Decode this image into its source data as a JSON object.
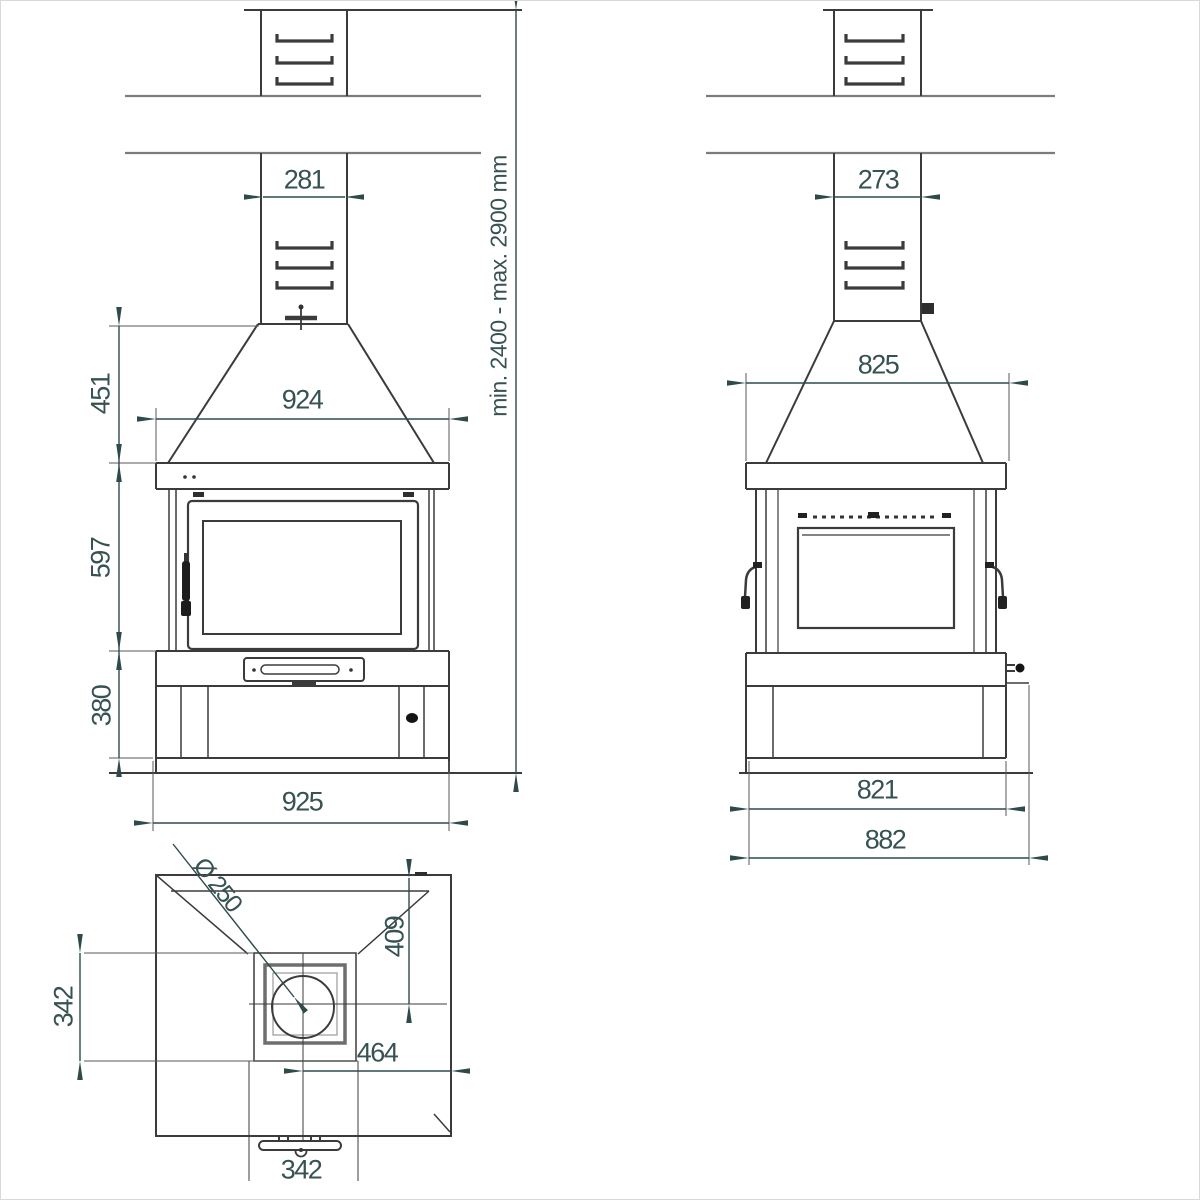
{
  "drawing_type": "fireplace-technical-drawing",
  "accent_color": "#2f4a4a",
  "dimensions": {
    "front": {
      "chimney_width": "281",
      "hood_height": "451",
      "hood_width": "924",
      "firebox_height": "597",
      "base_height": "380",
      "overall_width": "925",
      "ceiling_height_range": "min. 2400 - max. 2900 mm"
    },
    "side": {
      "chimney_depth": "273",
      "hood_depth": "825",
      "body_depth": "821",
      "overall_depth": "882"
    },
    "top": {
      "flue_diameter": "Ø 250",
      "flue_center_from_back": "409",
      "flue_box_depth": "342",
      "flue_center_to_side": "464",
      "flue_box_width": "342"
    }
  }
}
